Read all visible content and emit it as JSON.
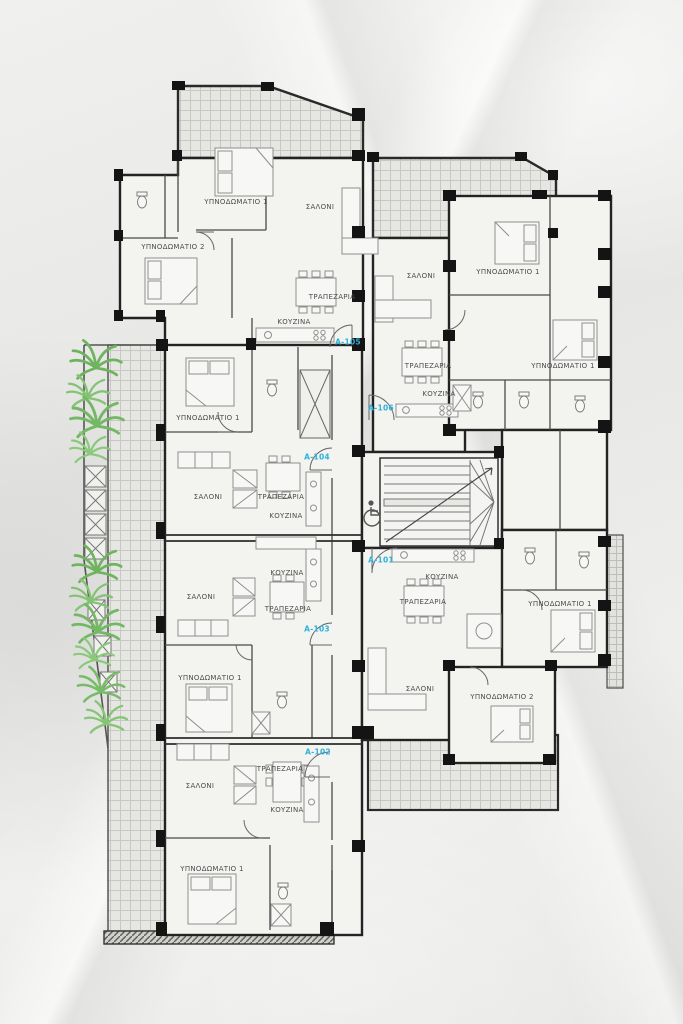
{
  "plan": {
    "type": "architectural-floor-plan",
    "language": "Greek",
    "room_legend": {
      "ΥΠΝΟΔΩΜΑΤΙΟ": "bedroom",
      "ΣΑΛΟΝΙ": "living room",
      "ΤΡΑΠΕΖΑΡΙΑ": "dining room",
      "ΚΟΥΖΙΝΑ": "kitchen"
    },
    "colors": {
      "unit_label": "#2fb0da",
      "room_label": "#4c4c4c",
      "wall": "#1f1f1f",
      "plant": "#79ba69",
      "paper": "#e9e9e7"
    },
    "icons": {
      "accessible": "wheelchair-icon",
      "plants": "palm-plant-icon",
      "stairs": "staircase"
    },
    "room_labels": [
      {
        "label": "ΥΠΝΟΔΩΜΑΤΙΟ 1",
        "x": 236,
        "y": 202
      },
      {
        "label": "ΥΠΝΟΔΩΜΑΤΙΟ 2",
        "x": 173,
        "y": 247
      },
      {
        "label": "ΣΑΛΟΝΙ",
        "x": 320,
        "y": 207
      },
      {
        "label": "ΤΡΑΠΕΖΑΡΙΑ",
        "x": 332,
        "y": 297
      },
      {
        "label": "ΚΟΥΖΙΝΑ",
        "x": 294,
        "y": 322
      },
      {
        "label": "ΣΑΛΟΝΙ",
        "x": 421,
        "y": 276
      },
      {
        "label": "ΥΠΝΟΔΩΜΑΤΙΟ 1",
        "x": 508,
        "y": 272
      },
      {
        "label": "ΤΡΑΠΕΖΑΡΙΑ",
        "x": 428,
        "y": 366
      },
      {
        "label": "ΚΟΥΖΙΝΑ",
        "x": 439,
        "y": 394
      },
      {
        "label": "ΥΠΝΟΔΩΜΑΤΙΟ 1",
        "x": 563,
        "y": 366
      },
      {
        "label": "ΥΠΝΟΔΩΜΑΤΙΟ 1",
        "x": 208,
        "y": 418
      },
      {
        "label": "ΣΑΛΟΝΙ",
        "x": 208,
        "y": 497
      },
      {
        "label": "ΤΡΑΠΕΖΑΡΙΑ",
        "x": 281,
        "y": 497
      },
      {
        "label": "ΚΟΥΖΙΝΑ",
        "x": 286,
        "y": 516
      },
      {
        "label": "ΚΟΥΖΙΝΑ",
        "x": 287,
        "y": 573
      },
      {
        "label": "ΣΑΛΟΝΙ",
        "x": 201,
        "y": 597
      },
      {
        "label": "ΤΡΑΠΕΖΑΡΙΑ",
        "x": 288,
        "y": 609
      },
      {
        "label": "ΥΠΝΟΔΩΜΑΤΙΟ 1",
        "x": 210,
        "y": 678
      },
      {
        "label": "ΚΟΥΖΙΝΑ",
        "x": 442,
        "y": 577
      },
      {
        "label": "ΤΡΑΠΕΖΑΡΙΑ",
        "x": 423,
        "y": 602
      },
      {
        "label": "ΥΠΝΟΔΩΜΑΤΙΟ 1",
        "x": 560,
        "y": 604
      },
      {
        "label": "ΣΑΛΟΝΙ",
        "x": 420,
        "y": 689
      },
      {
        "label": "ΥΠΝΟΔΩΜΑΤΙΟ 2",
        "x": 502,
        "y": 697
      },
      {
        "label": "ΤΡΑΠΕΖΑΡΙΑ",
        "x": 280,
        "y": 769
      },
      {
        "label": "ΣΑΛΟΝΙ",
        "x": 200,
        "y": 786
      },
      {
        "label": "ΚΟΥΖΙΝΑ",
        "x": 287,
        "y": 810
      },
      {
        "label": "ΥΠΝΟΔΩΜΑΤΙΟ 1",
        "x": 212,
        "y": 869
      }
    ],
    "unit_labels": [
      {
        "label": "A-105",
        "x": 348,
        "y": 342
      },
      {
        "label": "A-106",
        "x": 381,
        "y": 408
      },
      {
        "label": "A-104",
        "x": 317,
        "y": 457
      },
      {
        "label": "A-101",
        "x": 381,
        "y": 560
      },
      {
        "label": "A-103",
        "x": 317,
        "y": 629
      },
      {
        "label": "A-102",
        "x": 318,
        "y": 752
      }
    ]
  }
}
